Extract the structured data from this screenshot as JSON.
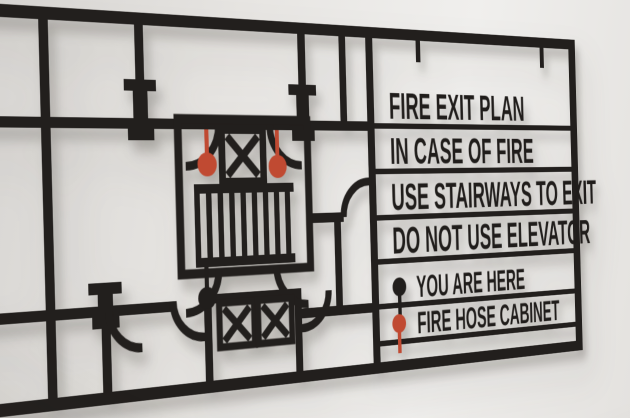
{
  "photo": {
    "description": "Black laser-cut fire exit floor plan sign mounted on a light gray wall, photographed at an angle",
    "wall_color": "#e8e6e3",
    "sign_color": "#211f1d",
    "accent_red": "#c04a32"
  },
  "sign": {
    "messages": [
      "FIRE EXIT PLAN",
      "IN CASE OF FIRE",
      "USE STAIRWAYS TO EXIT",
      "DO NOT USE ELEVATOR"
    ],
    "legend": [
      {
        "label": "YOU ARE HERE",
        "marker": "location-pin",
        "marker_color": "#211e1c"
      },
      {
        "label": "FIRE HOSE CABINET",
        "marker": "fire-hose-pin",
        "marker_color": "#c04a32"
      }
    ],
    "floor_plan": {
      "elevator_symbols": 3,
      "stair_treads": 9,
      "fire_hose_pins": 2,
      "you_are_here_pins": 1,
      "door_swing_arcs": 8
    }
  }
}
